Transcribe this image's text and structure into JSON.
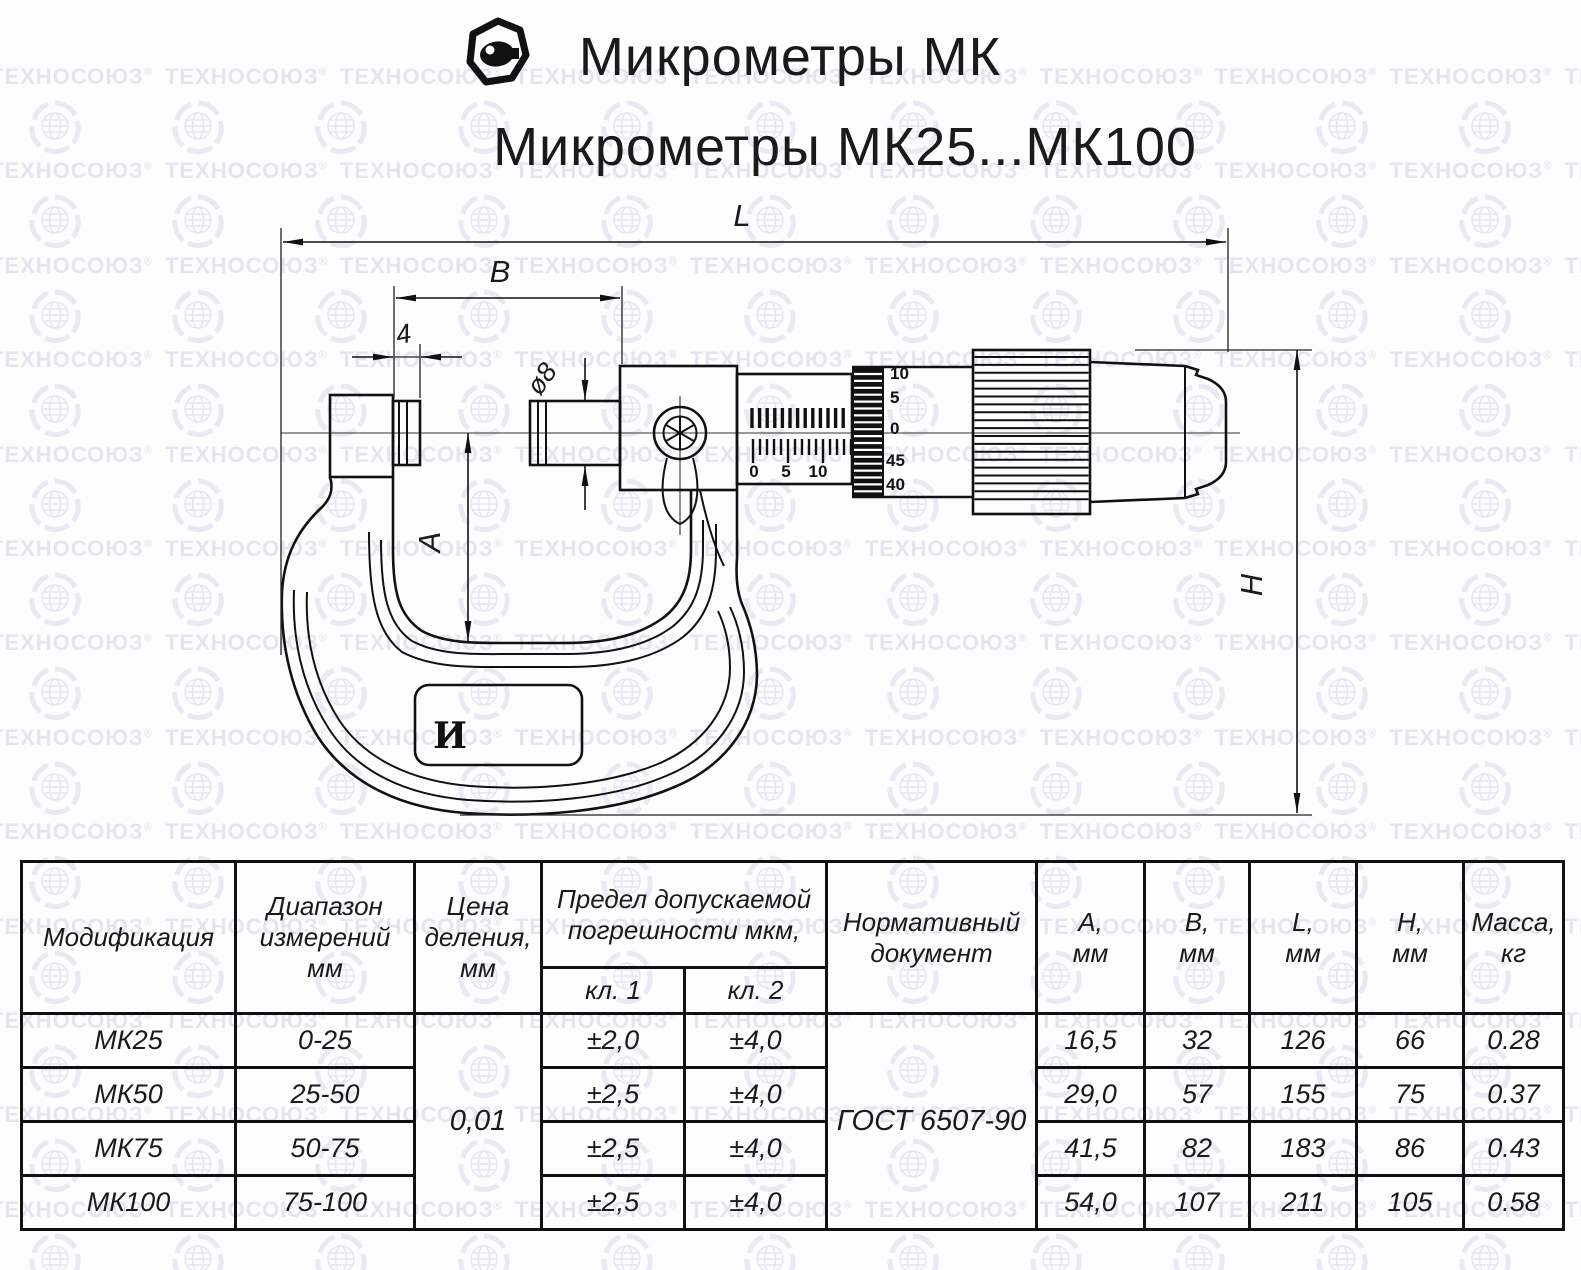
{
  "watermark": {
    "word": "ТЕХНОСОЮЗ",
    "reg": "®"
  },
  "header": {
    "title_line1": "Микрометры МК",
    "title_line2": "Микрометры МК25...МК100"
  },
  "drawing": {
    "dim_labels": {
      "L": "L",
      "B": "B",
      "anvil_len": "4",
      "spindle_dia": "ø8",
      "A": "A",
      "H": "H"
    },
    "sleeve_scale": {
      "t0": "0",
      "t5": "5",
      "t10": "10"
    },
    "thimble_scale": {
      "t10": "10",
      "t5": "5",
      "t0": "0",
      "t45": "45",
      "t40": "40"
    },
    "frame_plate_mark": "И"
  },
  "table": {
    "headers": {
      "modification": "Модификация",
      "range_1": "Диапазон",
      "range_2": "измерений",
      "range_3": "мм",
      "division_1": "Цена",
      "division_2": "деления,",
      "division_3": "мм",
      "error_1": "Предел допускаемой",
      "error_2": "погрешности мкм,",
      "class_1": "кл. 1",
      "class_2": "кл. 2",
      "doc_1": "Нормативный",
      "doc_2": "документ",
      "a_1": "А,",
      "b_1": "В,",
      "l_1": "L,",
      "h_1": "Н,",
      "mm": "мм",
      "mass_1": "Масса,",
      "mass_2": "кг"
    },
    "division_value": "0,01",
    "document_value": "ГОСТ 6507-90",
    "rows": [
      {
        "model": "МК25",
        "range": "0-25",
        "kl1": "±2,0",
        "kl2": "±4,0",
        "a": "16,5",
        "b": "32",
        "l": "126",
        "h": "66",
        "mass": "0.28"
      },
      {
        "model": "МК50",
        "range": "25-50",
        "kl1": "±2,5",
        "kl2": "±4,0",
        "a": "29,0",
        "b": "57",
        "l": "155",
        "h": "75",
        "mass": "0.37"
      },
      {
        "model": "МК75",
        "range": "50-75",
        "kl1": "±2,5",
        "kl2": "±4,0",
        "a": "41,5",
        "b": "82",
        "l": "183",
        "h": "86",
        "mass": "0.43"
      },
      {
        "model": "МК100",
        "range": "75-100",
        "kl1": "±2,5",
        "kl2": "±4,0",
        "a": "54,0",
        "b": "107",
        "l": "211",
        "h": "105",
        "mass": "0.58"
      }
    ]
  }
}
